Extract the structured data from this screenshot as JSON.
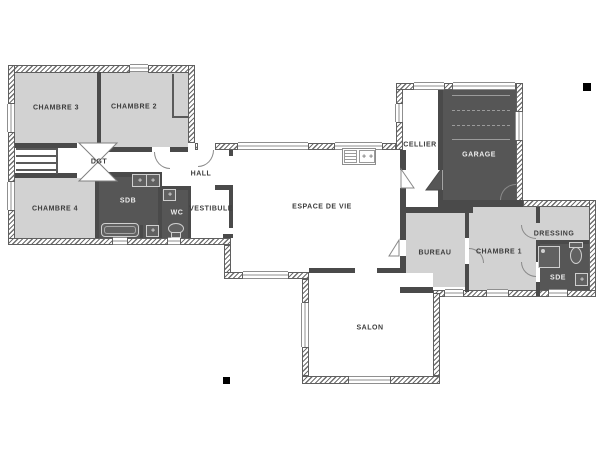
{
  "floorplan": {
    "title": "Plan de maison - rez-de-chaussee",
    "rooms": [
      {
        "name": "chambre-3",
        "label": "CHAMBRE 3"
      },
      {
        "name": "chambre-2",
        "label": "CHAMBRE 2"
      },
      {
        "name": "dgt",
        "label": "DGT"
      },
      {
        "name": "chambre-4",
        "label": "CHAMBRE 4"
      },
      {
        "name": "sdb",
        "label": "SDB"
      },
      {
        "name": "wc",
        "label": "WC"
      },
      {
        "name": "hall",
        "label": "HALL"
      },
      {
        "name": "vestibule",
        "label": "VESTIBULE"
      },
      {
        "name": "espace-de-vie",
        "label": "ESPACE DE VIE"
      },
      {
        "name": "cellier",
        "label": "CELLIER"
      },
      {
        "name": "garage",
        "label": "GARAGE"
      },
      {
        "name": "bureau",
        "label": "BUREAU"
      },
      {
        "name": "chambre-1",
        "label": "CHAMBRE 1"
      },
      {
        "name": "dressing",
        "label": "DRESSING"
      },
      {
        "name": "sde",
        "label": "SDE"
      },
      {
        "name": "salon",
        "label": "SALON"
      }
    ],
    "colors": {
      "room_light": "#d2d2d2",
      "room_dark": "#565656",
      "wall": "#4a4a4a",
      "label_dark": "#3c3c3c",
      "label_light": "#ededed",
      "marker": "#000000"
    },
    "fixtures": [
      "double-sink",
      "bathtub",
      "washer",
      "wc-sink",
      "wc-toilet",
      "kitchen-sink",
      "garage-door",
      "shower",
      "sde-toilet",
      "sde-sink"
    ],
    "markers": {
      "count": 2
    }
  }
}
